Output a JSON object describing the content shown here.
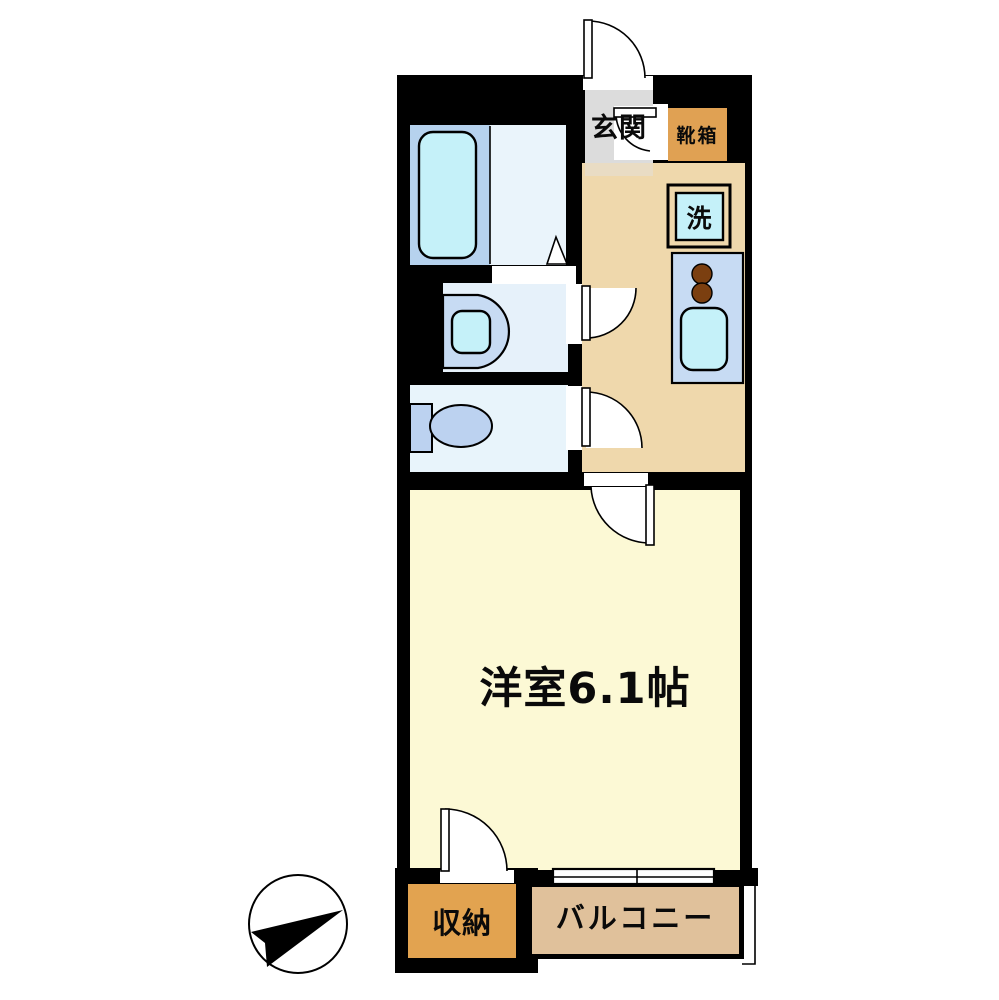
{
  "floorplan": {
    "labels": {
      "entrance": "玄関",
      "shoe_box": "靴箱",
      "laundry": "洗",
      "western_room": "洋室6.1帖",
      "storage": "収納",
      "balcony": "バルコニー"
    },
    "colors": {
      "wall": "#000000",
      "entrance_floor": "#dcdcdc",
      "entrance_step": "#e9dcc4",
      "kitchen_floor": "#efd8ac",
      "room_floor": "#fcf9d5",
      "storage_fill": "#e2a350",
      "shoe_box_fill": "#e0a153",
      "balcony_fill": "#e0c19b",
      "bath_floor": "#b6d2ee",
      "bath_inner_floor": "#eaf4fb",
      "washroom_floor": "#e6f1fa",
      "toilet_room_floor": "#e8f4fb",
      "fixture_cyan": "#c5f1f9",
      "fixture_blue": "#c7dbf3",
      "toilet_blue": "#bcd2f0",
      "burner_brown": "#7b3f10"
    },
    "icons": {
      "compass": "north-arrow"
    }
  }
}
